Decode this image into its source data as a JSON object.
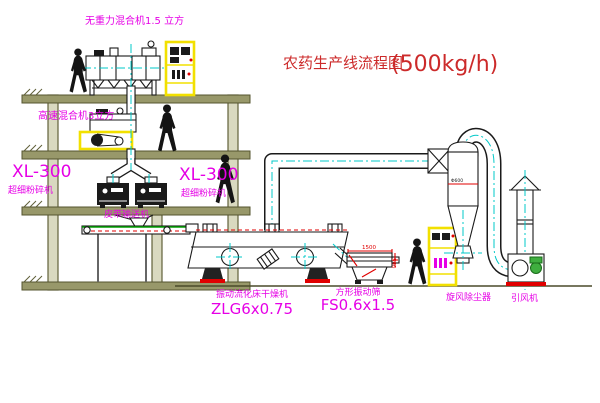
{
  "title": {
    "text": "农药生产线流程图",
    "capacity": "(500kg/h)"
  },
  "labels": {
    "gravity_mixer": "无重力混合机1.5 立方",
    "high_speed_mixer": "高速混合机3立方",
    "mill_left_model": "XL-300",
    "mill_left_name": "超细粉碎机",
    "mill_center_model": "XL-300",
    "mill_center_name": "超细粉碎机",
    "belt_conveyor": "皮带输送机",
    "dryer_name": "振动流化床干燥机",
    "dryer_model": "ZLG6x0.75",
    "screen_name": "方形振动筛",
    "screen_model": "FS0.6x1.5",
    "cyclone": "旋风除尘器",
    "fan": "引风机"
  },
  "dimensions": {
    "screen_length": "1500",
    "screen_height": "540",
    "cyclone_diameter": "Φ600"
  },
  "colors": {
    "label_magenta": "#e600e6",
    "title_red": "#cc2a2a",
    "structure_olive": "#98986a",
    "centerline_cyan": "#00c8c8",
    "cabinet_yellow": "#f2e000",
    "detail_red": "#e00000",
    "conveyor_green": "#00a000"
  }
}
